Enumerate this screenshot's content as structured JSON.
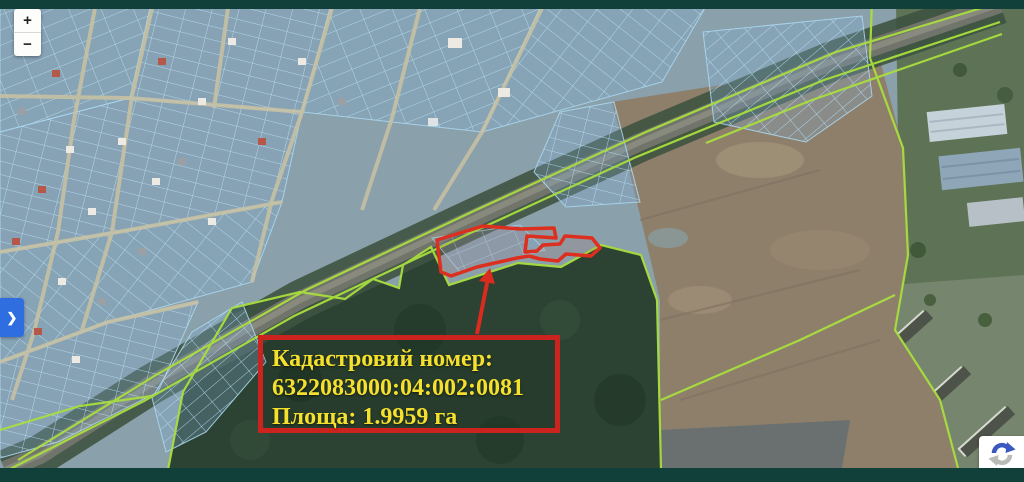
{
  "annotation": {
    "cadastral_label": "Кадастровий номер:",
    "cadastral_number": "6322083000:04:002:0081",
    "area_label": "Площа: 1.9959 га"
  },
  "map_controls": {
    "zoom_in": "+",
    "zoom_out": "−",
    "expand_panel": "❯"
  },
  "colors": {
    "annotation_border": "#cd231e",
    "annotation_text": "#f5e12d",
    "highlighted_parcel": "#dd2f1f",
    "cadastral_boundary_line": "#a9de3e",
    "parcel_grid_line": "#9fd4ea",
    "panel_button": "#2e6ee0",
    "letterbox": "#11403a"
  }
}
